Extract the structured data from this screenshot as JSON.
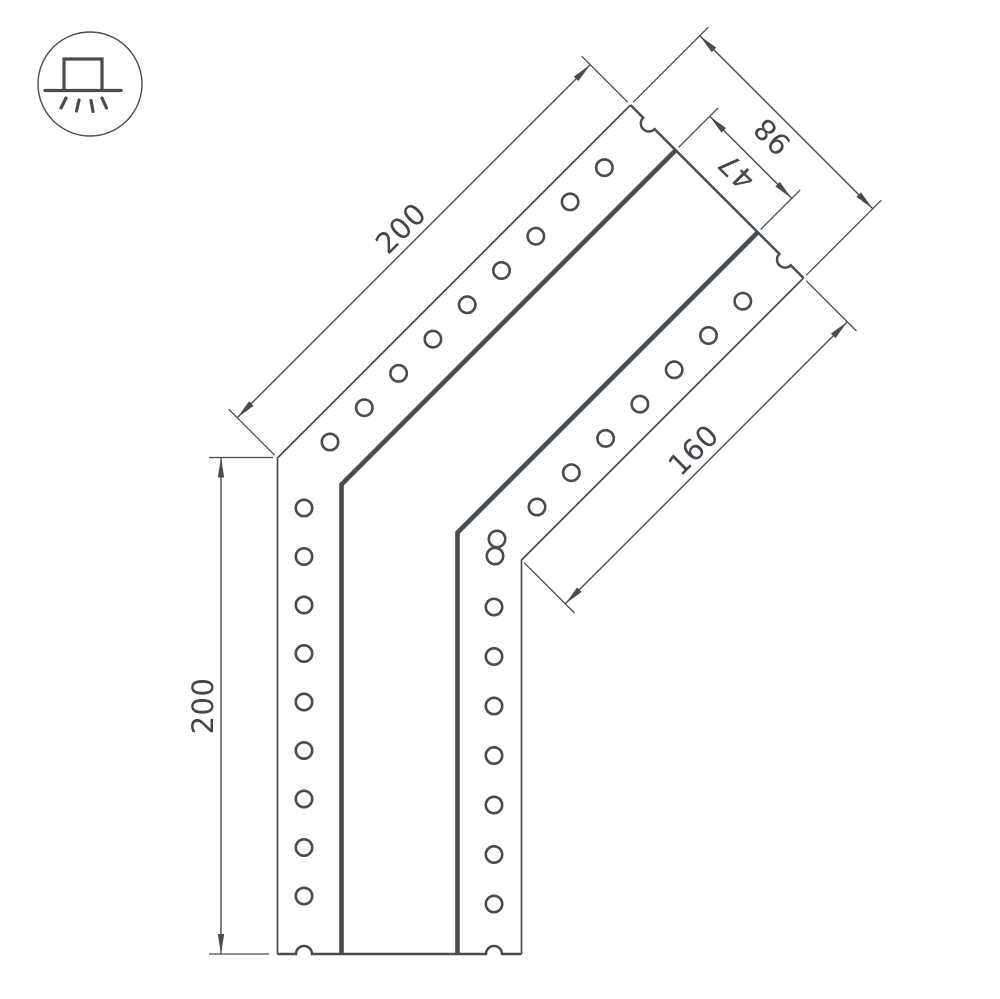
{
  "drawing": {
    "icon": {
      "name": "surface-mounted-luminaire-icon"
    },
    "labels": {
      "leg_top_length": "200",
      "leg_left_length": "200",
      "end_width": "98",
      "channel_width": "47",
      "inner_edge_length": "160"
    },
    "colors": {
      "line": "#474c51",
      "text": "#41464b",
      "background": "#ffffff"
    }
  }
}
